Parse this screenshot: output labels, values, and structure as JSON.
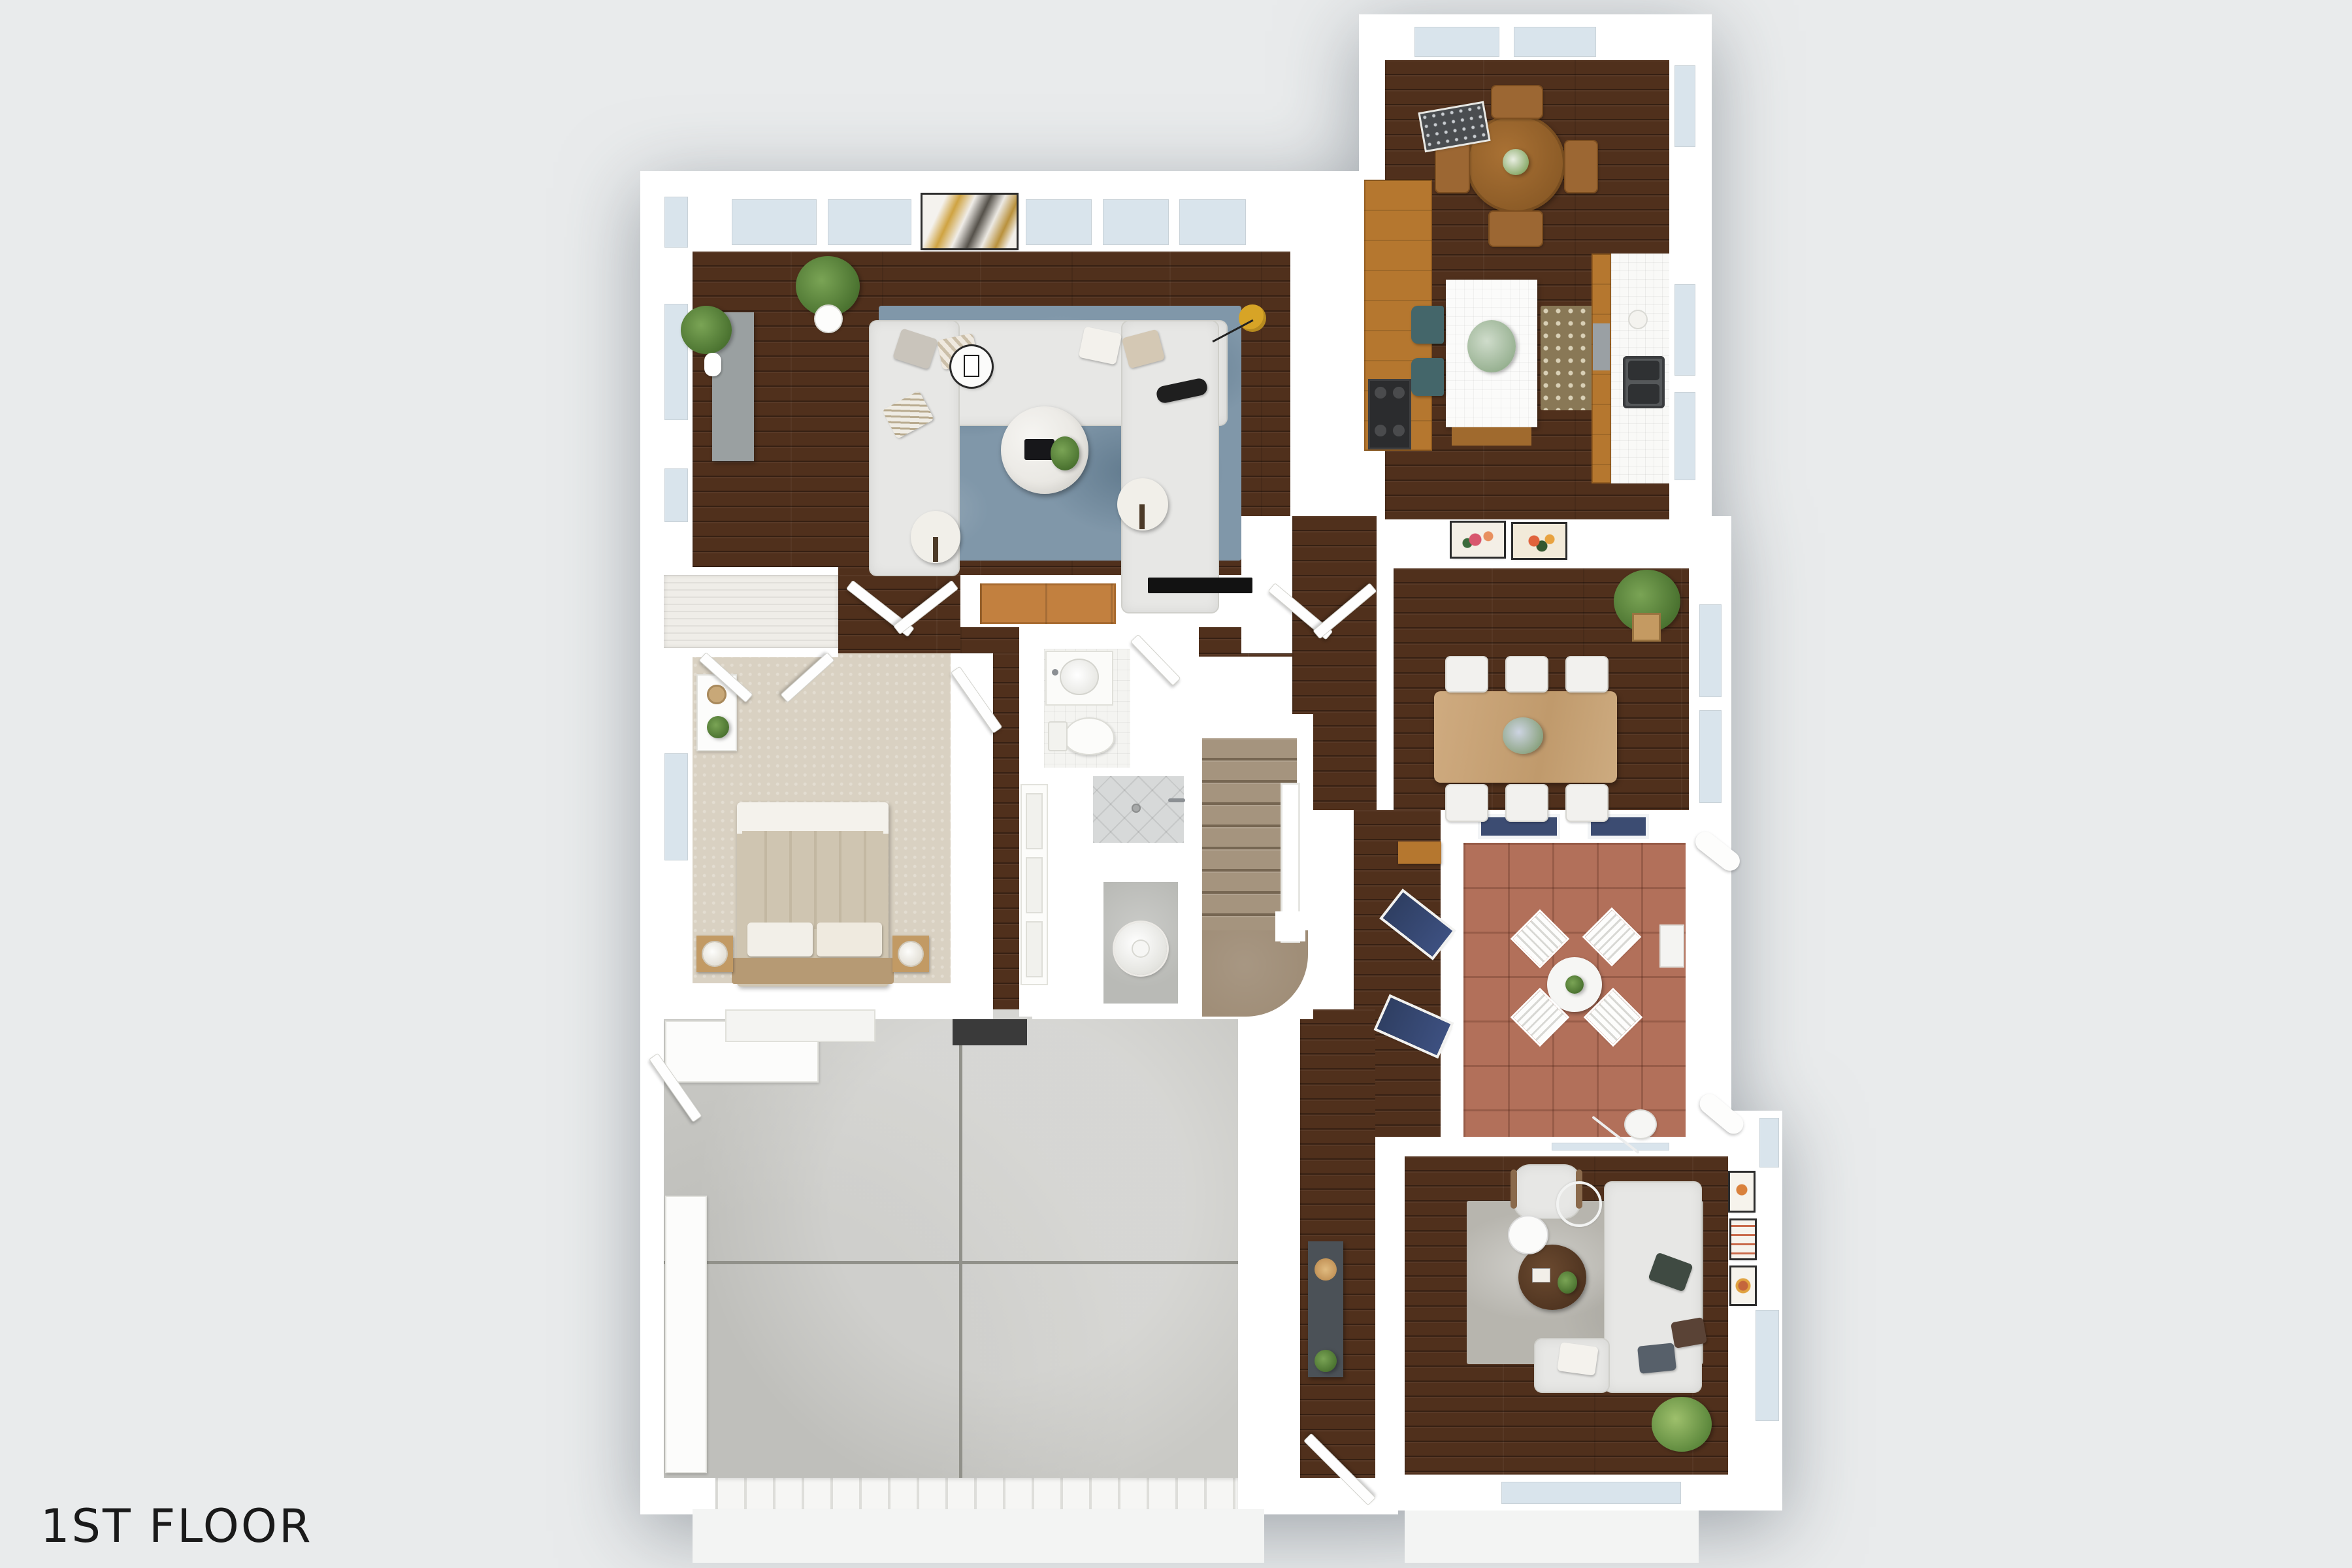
{
  "floorplan": {
    "label": "1ST FLOOR",
    "view": "3d-top-down-render",
    "palette": {
      "background": "#e9ebec",
      "walls": "#ffffff",
      "wood_floor": "#50301c",
      "bedroom_carpet": "#d9d1c2",
      "garage_concrete": "#c9c9c5",
      "patio_tile": "#b2705a",
      "stairs_carpet": "#a5947e",
      "living_rug": "#8097a9",
      "family_rug": "#b7b5ae",
      "kitchen_rug": "#897856",
      "sofa_fabric": "#e7e7e5",
      "teal_stool": "#44666a",
      "navy_lounger": "#2f3f63",
      "gold_lamp": "#d7a426",
      "label_color": "#1a1a1a"
    },
    "rooms": [
      {
        "id": "living-room",
        "floor": "wood",
        "features": [
          "u-sectional-sofa",
          "blue-area-rug",
          "marble-coffee-table",
          "two-ottomans",
          "media-console",
          "potted-plants",
          "wall-tv",
          "entry-bench"
        ]
      },
      {
        "id": "breakfast-nook-kitchen",
        "floor": "wood",
        "features": [
          "round-dining-table",
          "four-wood-chairs",
          "white-island",
          "two-teal-stools",
          "double-sink",
          "range",
          "speckled-rug",
          "granite-console"
        ]
      },
      {
        "id": "dining-room",
        "floor": "wood",
        "features": [
          "rectangular-table",
          "six-white-chairs",
          "fiddle-leaf-plant",
          "two-floral-artworks"
        ]
      },
      {
        "id": "patio",
        "floor": "terracotta-tile",
        "features": [
          "round-bistro-table",
          "four-folding-chairs",
          "two-navy-loungers"
        ]
      },
      {
        "id": "family-room",
        "floor": "wood",
        "features": [
          "l-sectional-sofa",
          "armchair",
          "gray-rug",
          "round-coffee-table",
          "arc-floor-lamp",
          "three-wall-frames",
          "corner-plant"
        ]
      },
      {
        "id": "bedroom",
        "floor": "carpet",
        "features": [
          "bed",
          "two-nightstands",
          "dresser",
          "closet-with-open-doors",
          "window"
        ]
      },
      {
        "id": "bathroom",
        "floor": "white-tile",
        "features": [
          "vanity-sink",
          "toilet"
        ]
      },
      {
        "id": "shower-room",
        "floor": "gray-tile",
        "features": [
          "walk-in-shower"
        ]
      },
      {
        "id": "utility-closet",
        "floor": "concrete",
        "features": [
          "water-heater",
          "laundry-closet"
        ]
      },
      {
        "id": "stairs",
        "floor": "carpet",
        "features": [
          "eight-treads",
          "white-railing",
          "curved-landing"
        ]
      },
      {
        "id": "garage",
        "floor": "concrete",
        "features": [
          "expansion-seams",
          "garage-door",
          "storage-cabinets",
          "workbench"
        ]
      },
      {
        "id": "entry-hall",
        "floor": "wood",
        "features": [
          "console-table",
          "front-door"
        ]
      }
    ]
  }
}
